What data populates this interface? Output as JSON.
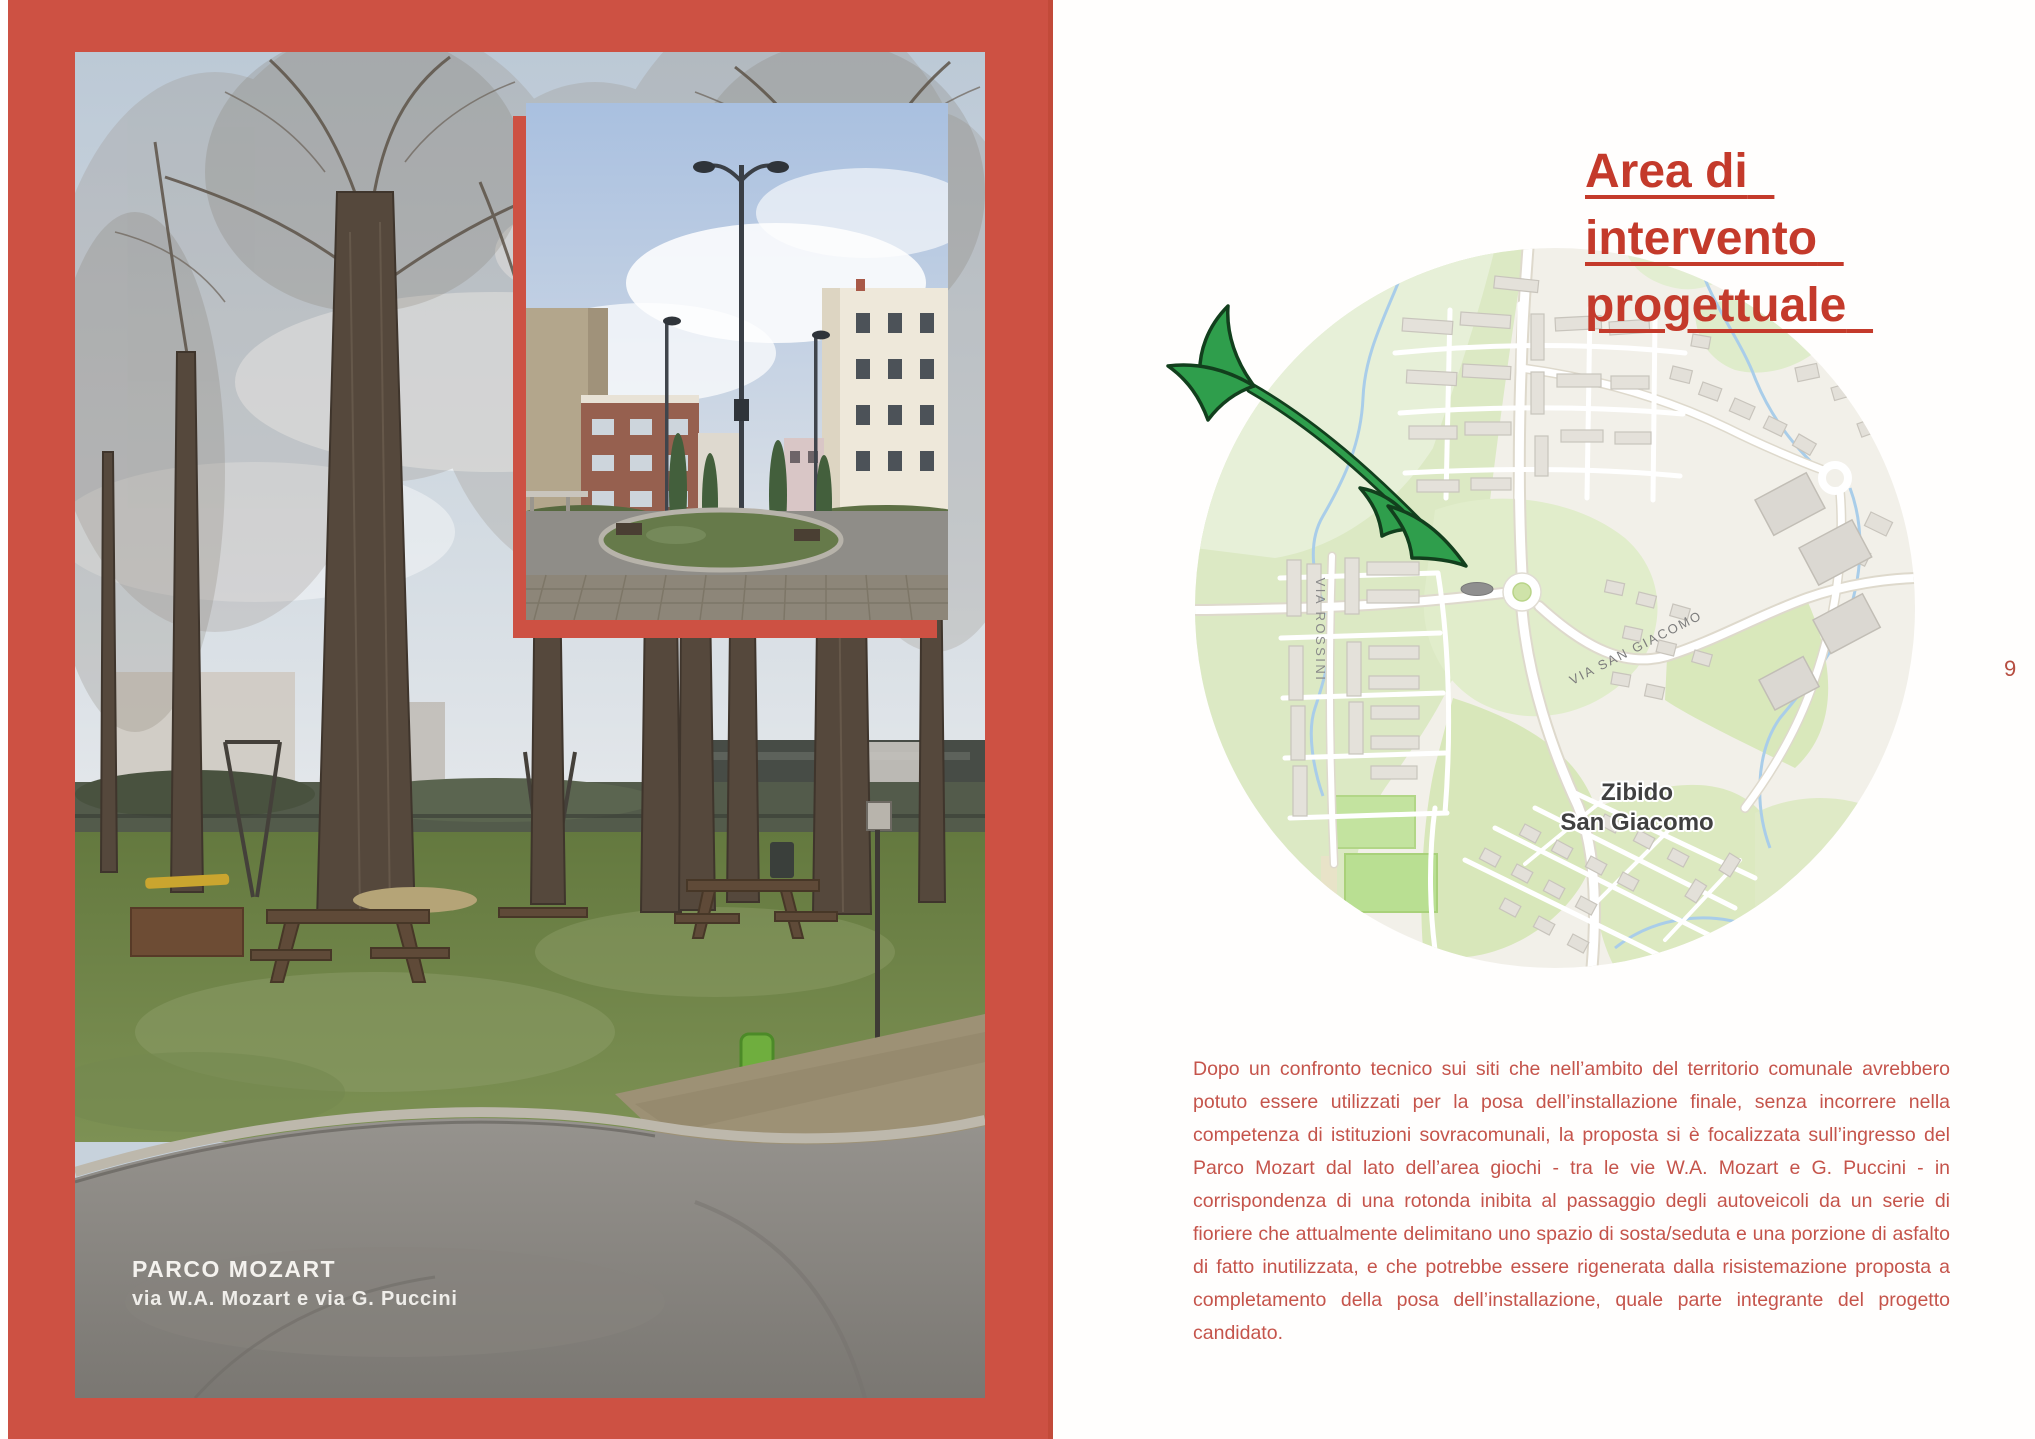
{
  "page": {
    "number": "9"
  },
  "colors": {
    "panel_red": "#cd5143",
    "title_red": "#c43a2b",
    "body_red": "#c5544b",
    "arrow_green": "#2f9e4c",
    "map_field_green": "#dcead9",
    "map_label_gray": "#808080",
    "town_label_gray": "#404040"
  },
  "left_panel": {
    "caption_title": "PARCO MOZART",
    "caption_subtitle": "via W.A. Mozart e via G. Puccini"
  },
  "right_panel": {
    "title_lines": [
      "Area di",
      "intervento",
      "progettuale"
    ],
    "body_text": "Dopo un confronto tecnico sui siti che nell’ambito del territorio comunale avrebbero potuto essere utilizzati per la posa dell’installazione finale, senza incorrere nella competenza di istituzioni sovracomunali, la proposta si è focalizzata sull’ingresso del Parco Mozart dal lato dell’area giochi - tra le vie W.A. Mozart e G. Puccini - in corrispondenza di una rotonda inibita al passaggio degli autoveicoli da un serie di fioriere che attualmente delimitano uno spazio di sosta/seduta e una porzione di asfalto di fatto inutilizzata, e che potrebbe essere rigenerata dalla risistemazione proposta a completamento della posa dell’installazione, quale parte integrante del progetto candidato."
  },
  "map": {
    "town_label_line1": "Zibido",
    "town_label_line2": "San Giacomo",
    "street_label_rossini": "VIA ROSSINI",
    "street_label_san_giacomo": "VIA SAN GIACOMO",
    "arrow_icon": "green-arrow"
  }
}
